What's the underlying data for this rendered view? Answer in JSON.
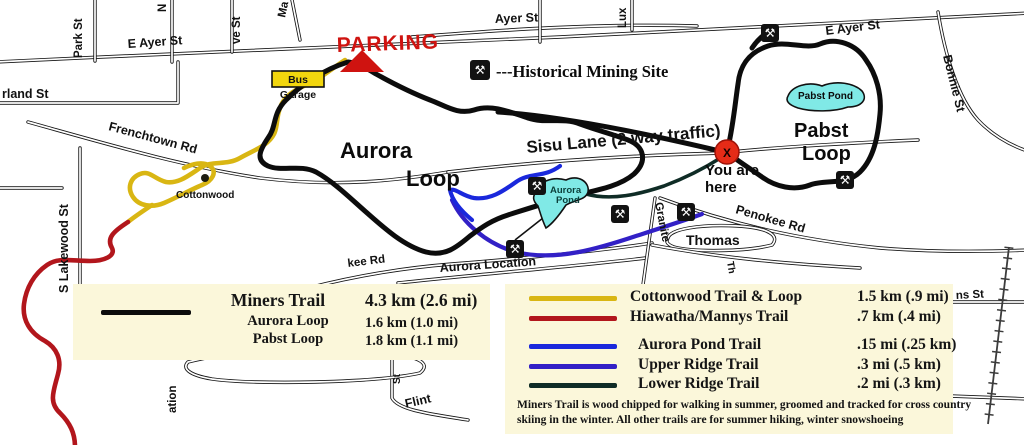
{
  "colors": {
    "miners": "#0c0c0c",
    "cottonwood": "#d9b613",
    "hiawatha": "#b2161c",
    "aurora_pond_trail": "#1a28dc",
    "upper_ridge": "#3220c6",
    "lower_ridge": "#0f2c26",
    "pond": "#80e9e6",
    "legend_bg": "#fbf7da",
    "marker": "#e52b17",
    "parking": "#cf1310",
    "bus": "#f2d60e"
  },
  "icons": {
    "mining_glyph": "⚒",
    "marker_glyph": "X"
  },
  "map": {
    "streets": {
      "park_st": "Park St",
      "n_fragment": "N",
      "ve_st_fragment": "ve St",
      "ma_fragment": "Ma",
      "e_ayer_st_west": "E Ayer St",
      "ayer_st": "Ayer St",
      "e_ayer_st_east": "E Ayer St",
      "lux_fragment": "Lux",
      "bonnie_st": "Bonnie St",
      "rland_st_fragment": "rland St",
      "frenchtown_rd": "Frenchtown Rd",
      "s_lakewood_st": "S Lakewood St",
      "sisu_lane": "Sisu Lane (2 way traffic)",
      "penokee_rd": "Penokee Rd",
      "kee_rd_fragment": "kee Rd",
      "aurora_location": "Aurora Location",
      "granite_fragment": "Granite",
      "thomas": "Thomas",
      "th_fragment": "Th",
      "ation_fragment": "ation",
      "flint": "Flint",
      "flint_st_fragment": "St",
      "ns_st_fragment": "ns St"
    },
    "labels": {
      "parking": "PARKING",
      "bus": "Bus",
      "garage": "Garage",
      "historical_mining_site": "---Historical Mining Site",
      "cottonwood": "Cottonwood",
      "aurora_loop_1": "Aurora",
      "aurora_loop_2": "Loop",
      "pabst_loop_1": "Pabst",
      "pabst_loop_2": "Loop",
      "pabst_pond": "Pabst Pond",
      "aurora_pond_1": "Aurora",
      "aurora_pond_2": "Pond",
      "you_are_here_1": "You are",
      "you_are_here_2": "here"
    }
  },
  "legend_left": {
    "rows": [
      {
        "name": "Miners Trail",
        "dist": "4.3 km (2.6 mi)"
      },
      {
        "name": "Aurora Loop",
        "dist": "1.6 km (1.0 mi)"
      },
      {
        "name": "Pabst Loop",
        "dist": "1.8 km (1.1 mi)"
      }
    ]
  },
  "legend_right": {
    "rows": [
      {
        "name": "Cottonwood Trail & Loop",
        "dist": "1.5 km (.9 mi)"
      },
      {
        "name": "Hiawatha/Mannys Trail",
        "dist": ".7 km (.4 mi)"
      },
      {
        "name": "Aurora Pond Trail",
        "dist": ".15 mi (.25 km)"
      },
      {
        "name": "Upper Ridge Trail",
        "dist": ".3 mi (.5 km)"
      },
      {
        "name": "Lower Ridge Trail",
        "dist": ".2 mi (.3 km)"
      }
    ],
    "note_line1": "Miners Trail is  wood chipped for walking in summer, groomed and tracked for cross country",
    "note_line2": "skiing in the winter. All other trails are for summer hiking, winter snowshoeing"
  }
}
